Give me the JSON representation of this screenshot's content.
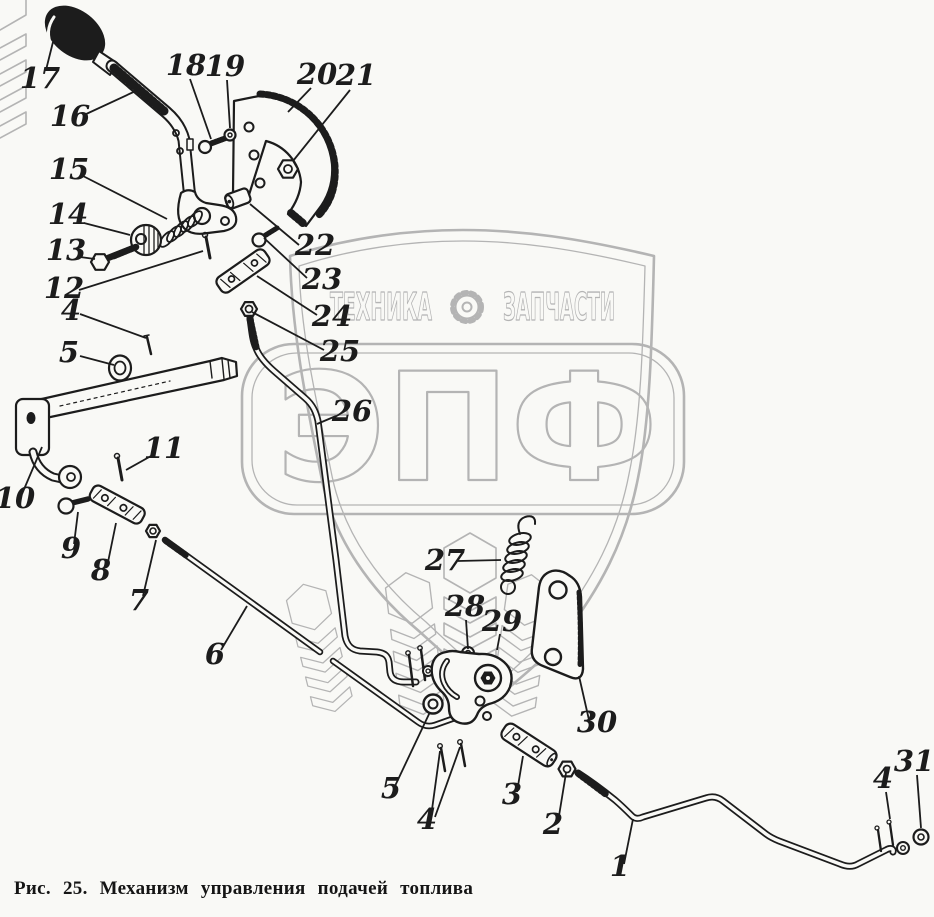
{
  "figure": {
    "caption": "Рис. 25. Механизм управления подачей топлива"
  },
  "watermark": {
    "brand_left": "ТЕХНИКА",
    "brand_right": "ЗАПЧАСТИ",
    "logo": "ЭПФ",
    "color": "#b4b4b4"
  },
  "drawing": {
    "ink_color": "#1c1c1c",
    "paper_color": "#f9f9f6"
  },
  "part_labels": [
    {
      "text": "17",
      "x": 40,
      "y": 88,
      "lines": [
        [
          46,
          70,
          53,
          42
        ]
      ]
    },
    {
      "text": "16",
      "x": 70,
      "y": 126,
      "lines": [
        [
          84,
          115,
          140,
          89
        ]
      ]
    },
    {
      "text": "18",
      "x": 186,
      "y": 75,
      "lines": [
        [
          190,
          79,
          211,
          139
        ]
      ]
    },
    {
      "text": "19",
      "x": 225,
      "y": 76,
      "lines": [
        [
          227,
          80,
          230,
          128
        ]
      ]
    },
    {
      "text": "20",
      "x": 317,
      "y": 84,
      "lines": [
        [
          311,
          88,
          288,
          112
        ]
      ]
    },
    {
      "text": "21",
      "x": 356,
      "y": 85,
      "lines": [
        [
          350,
          90,
          293,
          161
        ]
      ]
    },
    {
      "text": "15",
      "x": 69,
      "y": 179,
      "lines": [
        [
          83,
          176,
          167,
          219
        ]
      ]
    },
    {
      "text": "14",
      "x": 68,
      "y": 224,
      "lines": [
        [
          84,
          223,
          130,
          235
        ]
      ]
    },
    {
      "text": "13",
      "x": 66,
      "y": 260,
      "lines": [
        [
          80,
          257,
          95,
          259
        ]
      ]
    },
    {
      "text": "12",
      "x": 64,
      "y": 298,
      "lines": [
        [
          79,
          290,
          203,
          251
        ]
      ]
    },
    {
      "text": "4",
      "x": 71,
      "y": 320,
      "lines": [
        [
          80,
          314,
          146,
          338
        ]
      ]
    },
    {
      "text": "5",
      "x": 69,
      "y": 362,
      "lines": [
        [
          80,
          356,
          114,
          365
        ]
      ]
    },
    {
      "text": "22",
      "x": 315,
      "y": 255,
      "lines": [
        [
          299,
          245,
          250,
          204
        ]
      ]
    },
    {
      "text": "23",
      "x": 322,
      "y": 289,
      "lines": [
        [
          307,
          278,
          264,
          238
        ]
      ]
    },
    {
      "text": "24",
      "x": 332,
      "y": 326,
      "lines": [
        [
          317,
          315,
          257,
          276
        ]
      ]
    },
    {
      "text": "25",
      "x": 340,
      "y": 361,
      "lines": [
        [
          324,
          350,
          252,
          312
        ]
      ]
    },
    {
      "text": "26",
      "x": 352,
      "y": 421,
      "lines": [
        [
          336,
          416,
          317,
          424
        ]
      ]
    },
    {
      "text": "10",
      "x": 15,
      "y": 508,
      "lines": [
        [
          22,
          494,
          42,
          447
        ]
      ]
    },
    {
      "text": "11",
      "x": 164,
      "y": 458,
      "lines": [
        [
          151,
          456,
          126,
          470
        ]
      ]
    },
    {
      "text": "9",
      "x": 71,
      "y": 558,
      "lines": [
        [
          74,
          544,
          78,
          512
        ]
      ]
    },
    {
      "text": "8",
      "x": 101,
      "y": 580,
      "lines": [
        [
          107,
          567,
          116,
          523
        ]
      ]
    },
    {
      "text": "7",
      "x": 139,
      "y": 610,
      "lines": [
        [
          143,
          596,
          156,
          540
        ]
      ]
    },
    {
      "text": "6",
      "x": 215,
      "y": 664,
      "lines": [
        [
          221,
          650,
          247,
          606
        ]
      ]
    },
    {
      "text": "27",
      "x": 445,
      "y": 570,
      "lines": [
        [
          458,
          561,
          501,
          560
        ]
      ]
    },
    {
      "text": "28",
      "x": 465,
      "y": 616,
      "lines": [
        [
          466,
          620,
          468,
          649
        ]
      ]
    },
    {
      "text": "29",
      "x": 502,
      "y": 631,
      "lines": [
        [
          500,
          634,
          497,
          650
        ]
      ]
    },
    {
      "text": "30",
      "x": 597,
      "y": 732,
      "lines": [
        [
          589,
          720,
          579,
          676
        ]
      ]
    },
    {
      "text": "5",
      "x": 391,
      "y": 798,
      "lines": [
        [
          395,
          786,
          430,
          712
        ]
      ]
    },
    {
      "text": "4",
      "x": 427,
      "y": 829,
      "lines": [
        [
          431,
          817,
          440,
          751
        ],
        [
          435,
          817,
          460,
          747
        ]
      ]
    },
    {
      "text": "3",
      "x": 512,
      "y": 804,
      "lines": [
        [
          517,
          792,
          523,
          756
        ]
      ]
    },
    {
      "text": "2",
      "x": 553,
      "y": 834,
      "lines": [
        [
          558,
          822,
          566,
          773
        ]
      ]
    },
    {
      "text": "1",
      "x": 620,
      "y": 876,
      "lines": [
        [
          624,
          864,
          633,
          819
        ]
      ]
    },
    {
      "text": "4",
      "x": 883,
      "y": 788,
      "lines": [
        [
          886,
          792,
          890,
          819
        ]
      ]
    },
    {
      "text": "31",
      "x": 914,
      "y": 771,
      "lines": [
        [
          917,
          775,
          921,
          828
        ]
      ]
    }
  ]
}
